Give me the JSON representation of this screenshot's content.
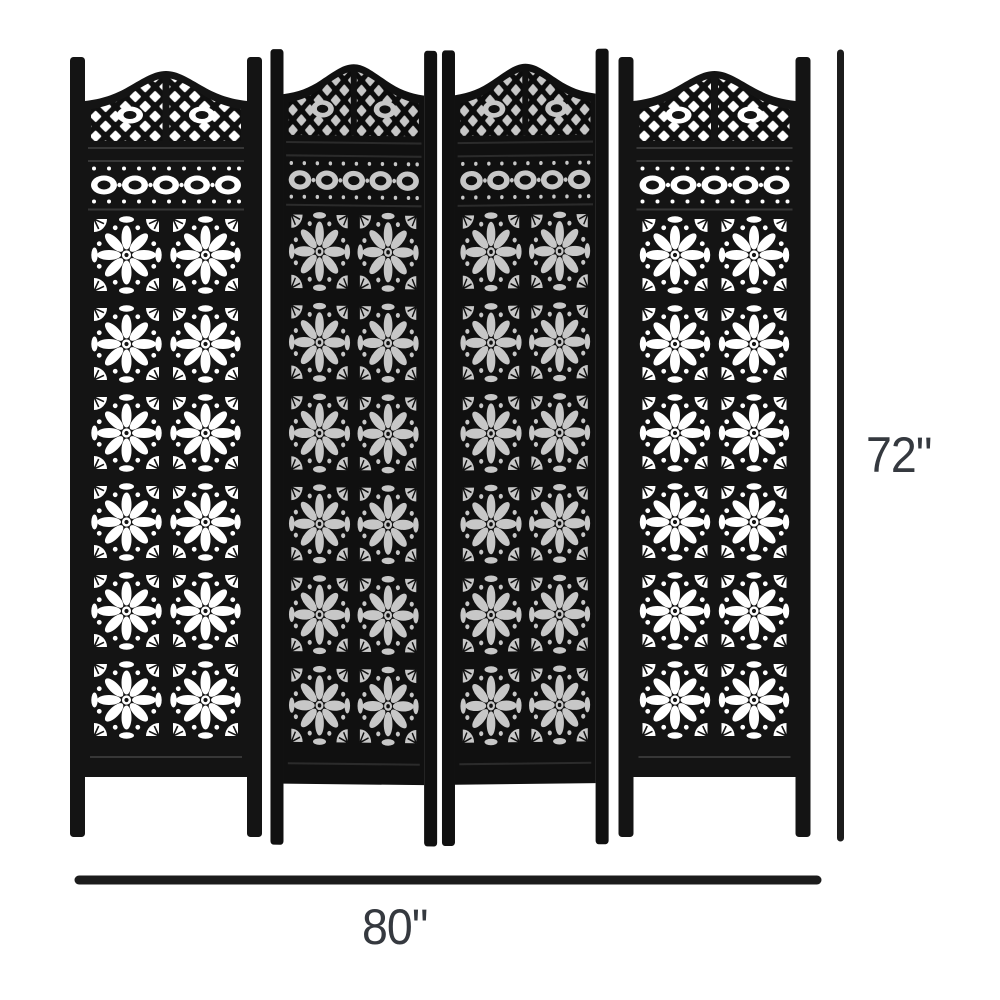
{
  "page": {
    "background_color": "#ffffff"
  },
  "figure": {
    "type": "four-panel-carved-folding-screen",
    "panels": 4,
    "rosette_rows_per_panel": 6,
    "rosette_cols_per_panel": 2,
    "body_color": "#141414",
    "cutout_color": "#ffffff",
    "folded_panel_brightness": "78%"
  },
  "dimensions": {
    "height": {
      "label": "72\""
    },
    "width": {
      "label": "80\""
    },
    "line_color": "#1c1c1c",
    "label_color": "#35393f"
  }
}
